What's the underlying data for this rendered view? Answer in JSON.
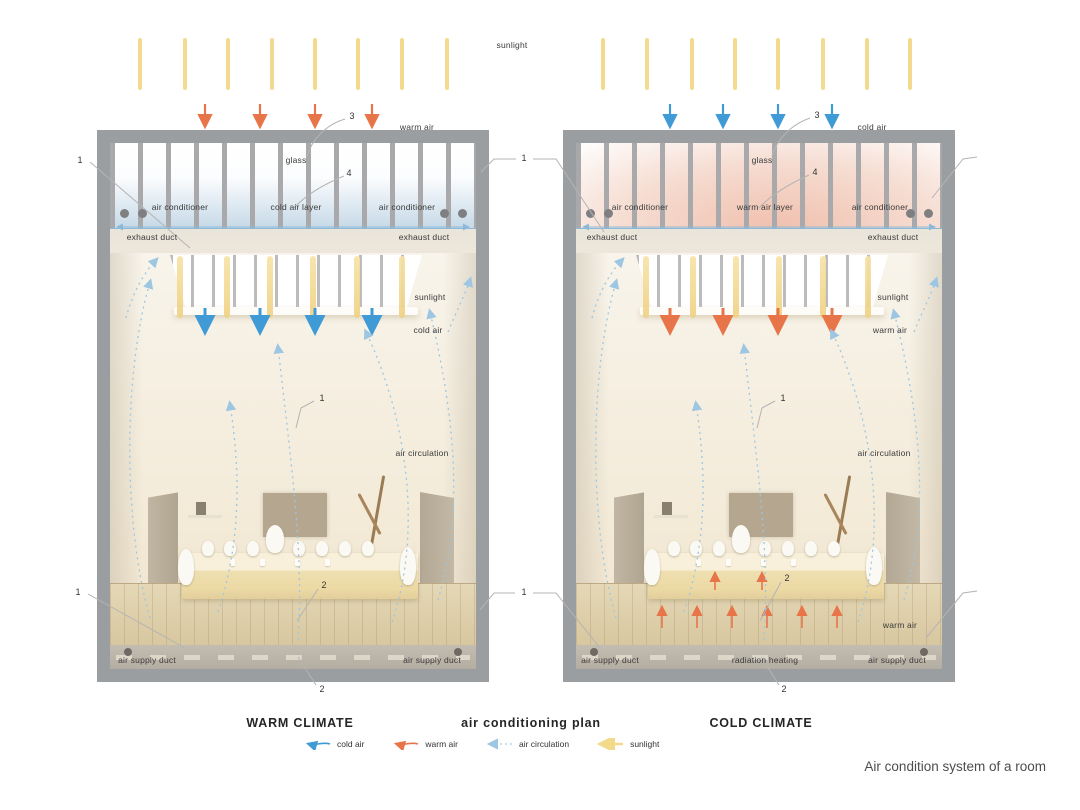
{
  "caption": "Air condition system of a room",
  "top": {
    "sunlight_label": "sunlight"
  },
  "footer": {
    "warm_title": "WARM CLIMATE",
    "plan_title": "air conditioning plan",
    "cold_title": "COLD CLIMATE"
  },
  "legend": {
    "items": [
      {
        "label": "cold air",
        "color": "#3f9ad6"
      },
      {
        "label": "warm air",
        "color": "#e8744a"
      },
      {
        "label": "air circulation",
        "color": "#a9cfe8"
      },
      {
        "label": "sunlight",
        "color": "#f3d98b"
      }
    ]
  },
  "callouts": {
    "one": "1",
    "two": "2",
    "three": "3",
    "four": "4"
  },
  "warm": {
    "top_air": "warm air",
    "glass": "glass",
    "air_layer": "cold air layer",
    "ac_left": "air conditioner",
    "ac_right": "air conditioner",
    "exhaust_left": "exhaust duct",
    "exhaust_right": "exhaust duct",
    "sunlight": "sunlight",
    "mid_air": "cold air",
    "circulation": "air circulation",
    "supply_left": "air supply duct",
    "supply_right": "air supply duct"
  },
  "cold": {
    "top_air": "cold air",
    "glass": "glass",
    "air_layer": "warm air layer",
    "ac_left": "air conditioner",
    "ac_right": "air conditioner",
    "exhaust_left": "exhaust duct",
    "exhaust_right": "exhaust duct",
    "sunlight": "sunlight",
    "mid_air": "warm air",
    "circulation": "air circulation",
    "floor_air": "warm air",
    "radiation": "radiation heating",
    "supply_left": "air supply duct",
    "supply_right": "air supply duct"
  },
  "colors": {
    "cold_air": "#3f9ad6",
    "warm_air": "#e8744a",
    "air_circulation": "#9cc6e2",
    "sunlight": "#f4da8e",
    "frame": "#9b9ea1",
    "room": "#f4efe5"
  }
}
